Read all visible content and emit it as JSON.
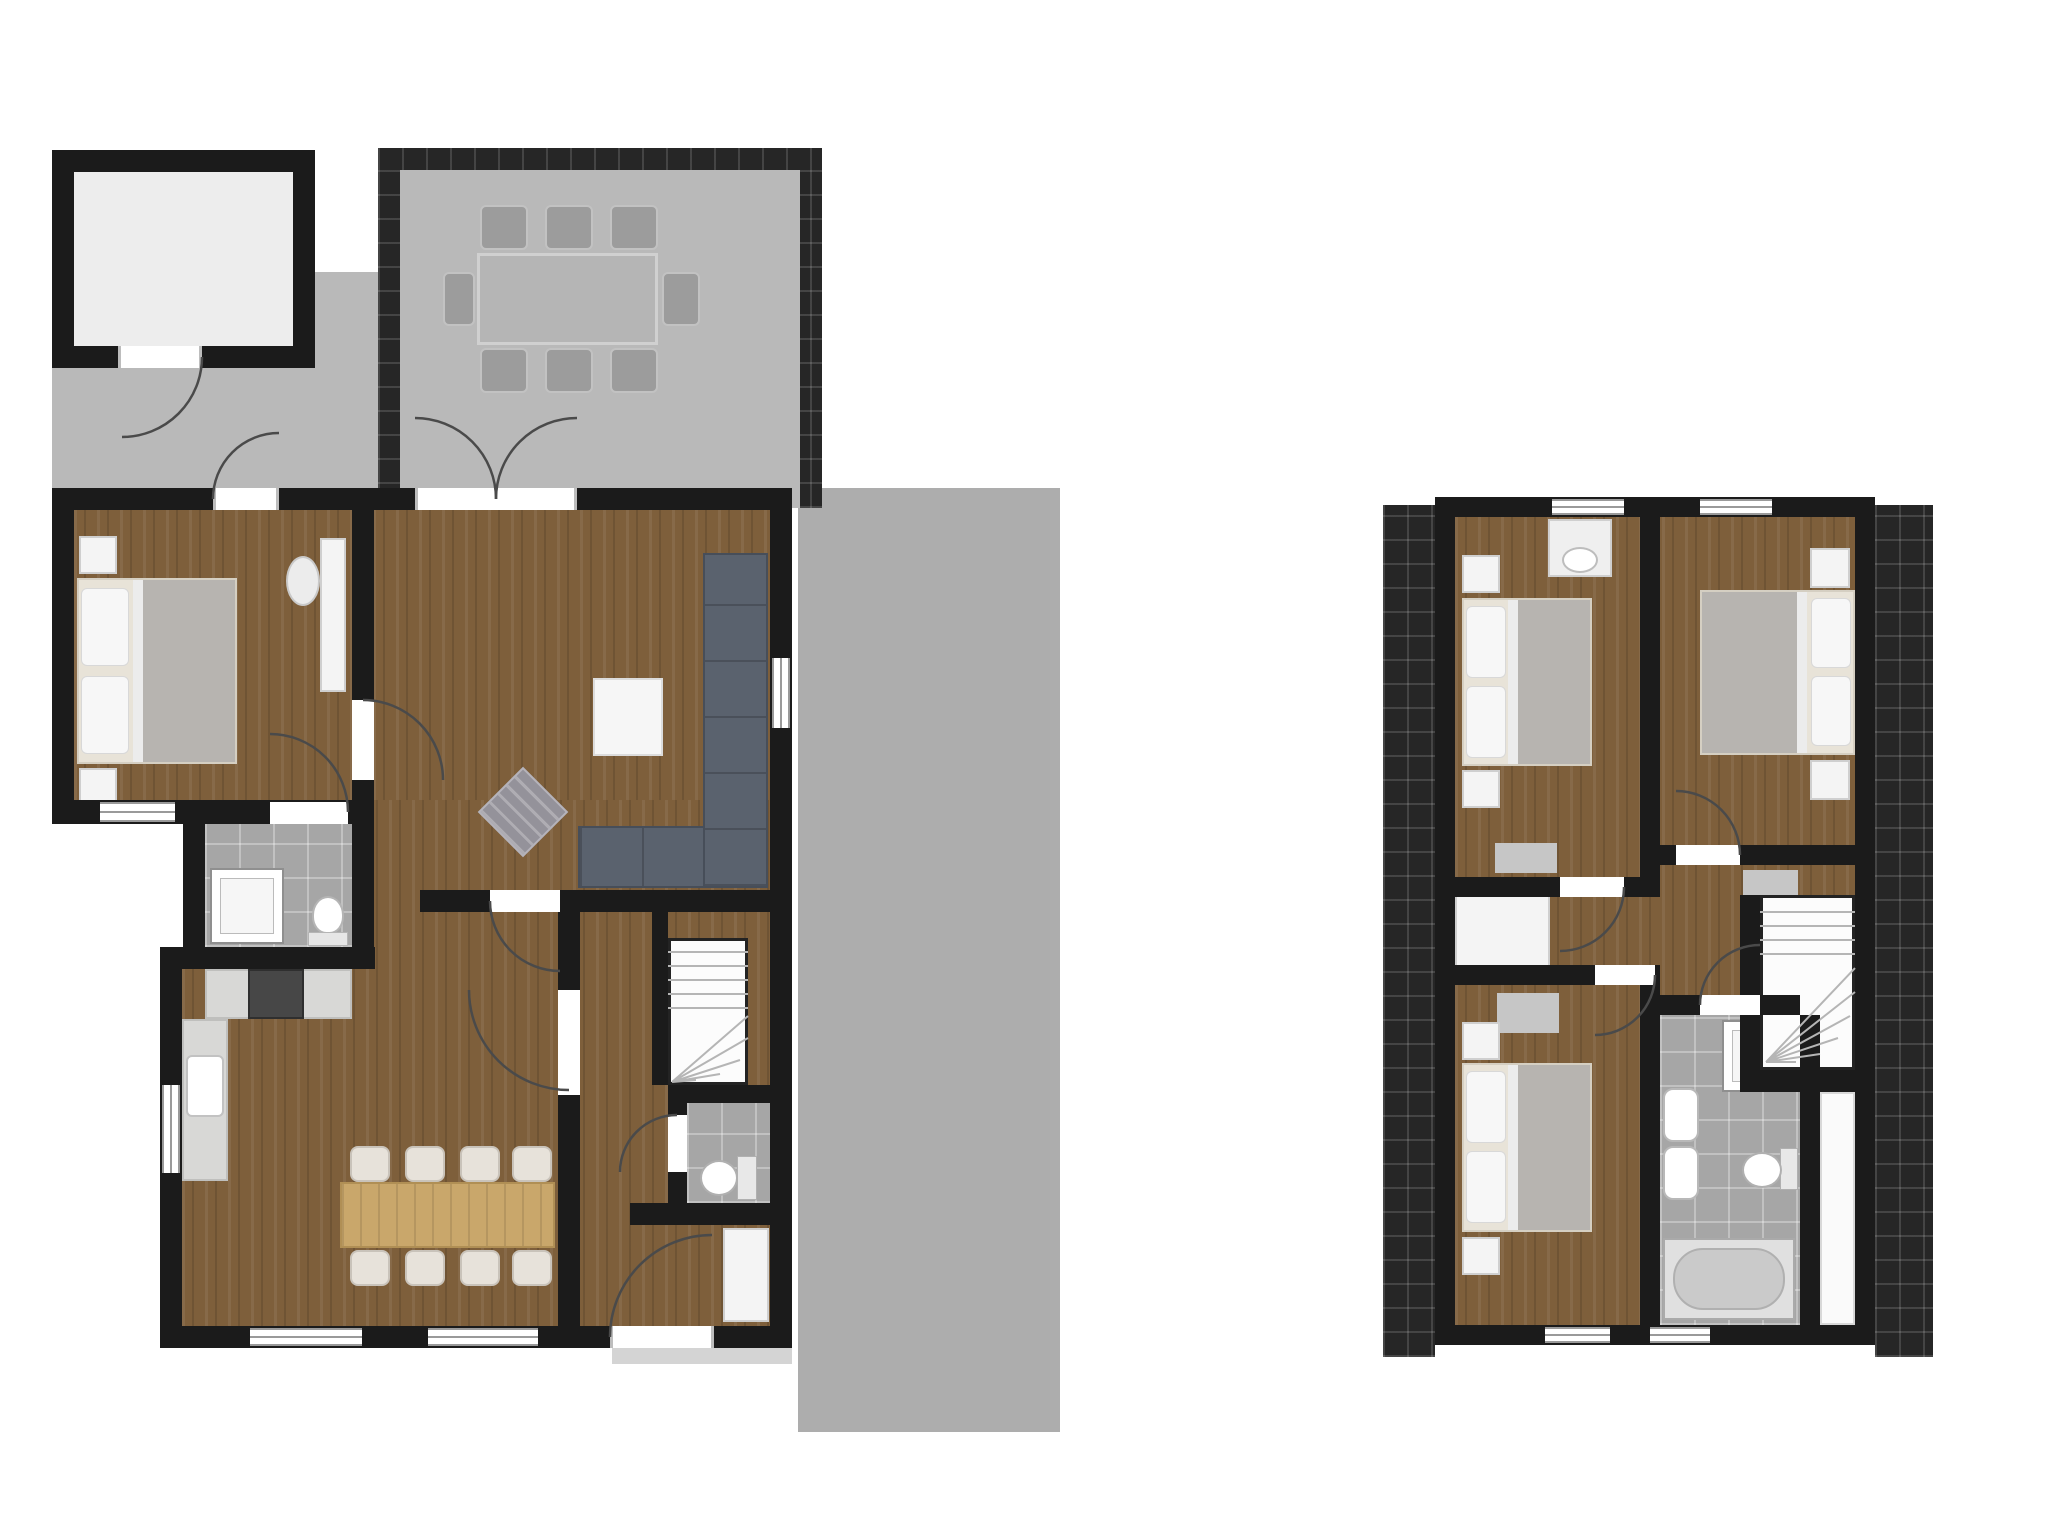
{
  "document": {
    "kind": "architectural floor plan, top-down render, no text labels",
    "floors": [
      {
        "name": "ground-floor",
        "rooms": [
          "shed",
          "terrace",
          "bedroom",
          "en-suite-bathroom",
          "living-room",
          "kitchen-dining",
          "hallway",
          "toilet-room",
          "stairwell"
        ],
        "exterior": [
          "paved-yard",
          "driveway",
          "door-step"
        ],
        "furniture": {
          "terrace": {
            "dining_table": 1,
            "outdoor_chairs": 8
          },
          "bedroom": {
            "double_bed": 1,
            "nightstands": 2,
            "desk": 1,
            "desk_chair": 1
          },
          "living_room": {
            "corner_sofa": 1,
            "coffee_table": 1,
            "diamond_rug": 1
          },
          "bathroom": {
            "shower": 1,
            "toilet": 1
          },
          "kitchen": {
            "counter_runs": 2,
            "stove": 1,
            "sink": 1,
            "dining_table": 1,
            "dining_chairs": 8
          },
          "toilet_room": {
            "toilet": 1
          },
          "hall": {
            "wardrobe": 1
          },
          "stairs": {
            "type": "winder",
            "location": "mid-right"
          }
        }
      },
      {
        "name": "upper-floor",
        "rooms": [
          "bedroom-1",
          "bedroom-2",
          "bedroom-3",
          "bathroom",
          "landing",
          "stairwell",
          "storage-strip"
        ],
        "roof": "dark tiled roof bands along left and right edges",
        "furniture": {
          "bedroom_1": {
            "double_bed": 1,
            "nightstands": 2,
            "wash_basin": 1,
            "door_mat": 1
          },
          "bedroom_2": {
            "double_bed": 1,
            "nightstands": 2,
            "door_mat": 1
          },
          "bedroom_3": {
            "double_bed": 1,
            "nightstands": 2,
            "door_mat": 1
          },
          "bathroom": {
            "shower": 1,
            "wash_basins": 2,
            "toilet": 1,
            "bathtub": 1
          },
          "landing": {
            "closet": 1
          },
          "stairs": {
            "type": "winder",
            "location": "mid-right"
          }
        }
      }
    ],
    "colors": {
      "wall": "#1b1b1b",
      "wood_floor": "#7e5f3b",
      "paving": "#b9b9b9",
      "driveway": "#adadad",
      "tile_edge": "#262626",
      "bath_tile": "#a6a6a6",
      "counter": "#d8d8d6",
      "stove": "#474747",
      "dining_table_wood": "#c9a76b",
      "chair_cream": "#e7e2da",
      "outdoor_gray": "#9c9c9c",
      "sofa": "#5a626e",
      "blanket": "#b7b4b0",
      "white_fixture": "#f4f4f4",
      "door_arc": "#4a4a4a"
    },
    "window_count": 13,
    "door_arc_count": 14
  }
}
